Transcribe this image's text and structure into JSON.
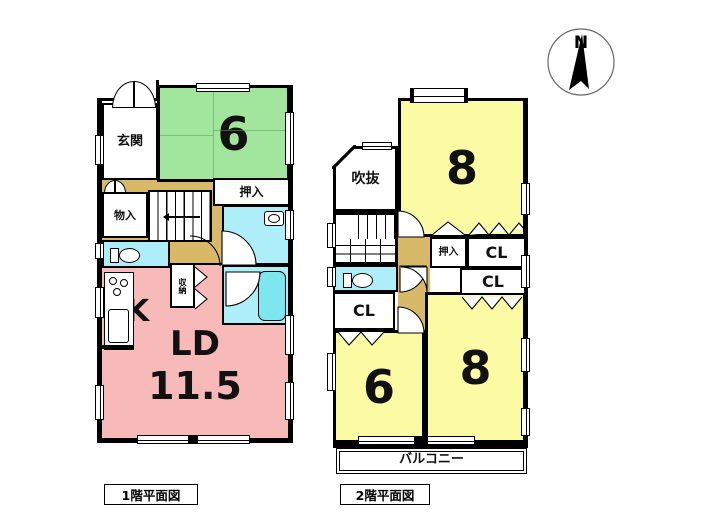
{
  "colors": {
    "tatami": "#a2e59c",
    "yellow": "#fbfba4",
    "pink": "#f8b9b9",
    "cyan": "#aeeef8",
    "tub": "#7de6ee",
    "tan": "#d8b967",
    "wall": "#000000",
    "bg": "#ffffff"
  },
  "compass": {
    "label": "N"
  },
  "floor1": {
    "caption": "1階平面図",
    "rooms": {
      "genkan": "玄関",
      "tatami": "6",
      "oshiire": "押入",
      "monoire": "物入",
      "shunou": "収納",
      "kitchen": "K",
      "living": "LD",
      "living_size": "11.5"
    }
  },
  "floor2": {
    "caption": "2階平面図",
    "rooms": {
      "fukinuke": "吹抜",
      "bedroom8_top": "8",
      "oshiire": "押入",
      "cl_top": "CL",
      "cl_mid": "CL",
      "cl_left": "CL",
      "bedroom6": "6",
      "bedroom8_bottom": "8",
      "balcony": "バルコニー"
    }
  }
}
